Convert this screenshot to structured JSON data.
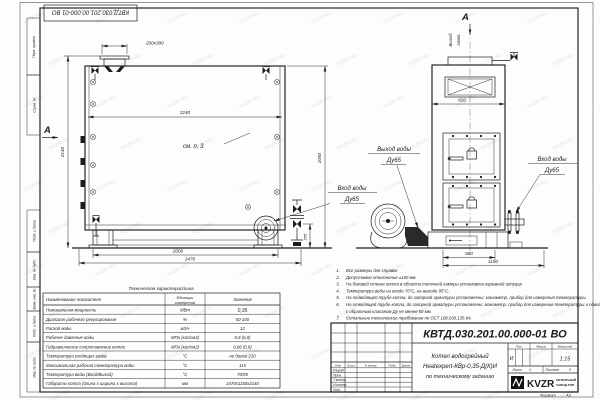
{
  "watermark": "KVZR.RU",
  "frame": {
    "doc_number_flipped": "КВТД.030.201.00.000-01 ВО",
    "format_label": "Формат",
    "format_value": "А3",
    "margin_labels": {
      "perv": "Перв. примен.",
      "sprav": "Справ. №",
      "podp1": "Подп. и дата",
      "inv_dubl": "Инв. № дубл.",
      "vzam": "Взам. инв. №",
      "podp2": "Подп. и дата",
      "inv_podl": "Инв. № подл."
    }
  },
  "front_view": {
    "section_letter": "А",
    "dim_chimney": "200х390",
    "dim_width_inner": "2240",
    "note_ref": "см. п. 3",
    "dim_height_total": "2140",
    "dim_height_body": "2050",
    "dim_inlet_height": "255",
    "dim_supports": "2000",
    "dim_length_total": "2470",
    "label_inlet_1": "Вход воды",
    "label_inlet_2": "Ду65"
  },
  "side_view": {
    "section_letter": "А",
    "label_gas_1": "Выход",
    "label_gas_2": "газов",
    "dim_width": "820",
    "dim_base": "580",
    "dim_depth": "1150",
    "label_outlet_1": "Выход воды",
    "label_outlet_2": "Ду65",
    "label_inlet_1": "Вход воды",
    "label_inlet_2": "Ду65"
  },
  "notes": {
    "items": [
      {
        "n": "1.",
        "t": "Все размеры для справок"
      },
      {
        "n": "2.",
        "t": "Допустимое отклонение ±100 мм."
      },
      {
        "n": "3.",
        "t": "На боковой стенке котла в области топочной камеры установлен взрывной штуцер"
      },
      {
        "n": "4.",
        "t": "Температура воды на входе 70°С, на выходе 95°С."
      },
      {
        "n": "5.",
        "t": "На подводящей трубе котла, до запорной арматуры установлены: манометр, прибор для измерения температуры."
      },
      {
        "n": "6.",
        "t": "На отводящей трубе котла, до запорной арматуры установлены: манометр, прибор для измерения температуры и обвод"
      },
      {
        "n": "",
        "t": "с обратным клапаном Ду не менее 50 мм."
      },
      {
        "n": "7.",
        "t": "Остальные технические требования по ОСТ 108.030.135-84."
      }
    ]
  },
  "spec_table": {
    "title": "Техническая характеристика",
    "col_name": "Наименование показателя",
    "col_units_1": "Единицы",
    "col_units_2": "измерения",
    "col_value": "Значение",
    "rows": [
      {
        "name": "Номинальная мощность",
        "units": "МВт",
        "value": "0,35"
      },
      {
        "name": "Диапазон рабочего регулирования",
        "units": "%",
        "value": "50-100"
      },
      {
        "name": "Расход воды",
        "units": "м3/ч",
        "value": "12"
      },
      {
        "name": "Рабочее давление воды",
        "units": "МПа (кгс/см2)",
        "value": "0,6 (6,0)"
      },
      {
        "name": "Гидравлическое сопротивление котла",
        "units": "МПа (кгс/см2)",
        "value": "0,06 (0,6)"
      },
      {
        "name": "Температура уходящих газов",
        "units": "°С",
        "value": "не более 220"
      },
      {
        "name": "Максимальная рабочая температура воды",
        "units": "°С",
        "value": "115"
      },
      {
        "name": "Температура воды (Вход/Выход)",
        "units": "°С",
        "value": "70/95"
      },
      {
        "name": "Габариты котла (длина х ширина х высота)",
        "units": "мм",
        "value": "2470х1150х2140"
      }
    ]
  },
  "title_block": {
    "doc_number": "КВТД.030.201.00.000-01 ВО",
    "name_line1": "Котел водогрейный",
    "name_line2": "Heatexpert-КВр-0,35-Д(К)И",
    "name_line3": "по техническому заданию",
    "col_izm": "Изм",
    "col_list": "Лист",
    "col_doc": "N докум.",
    "col_podp": "Подп.",
    "col_data": "Дата",
    "row_razrab": "Разраб.",
    "row_prov": "Пров.",
    "row_tkontr": "Т.контр.",
    "row_nkontr": "Н.контр.",
    "row_utv": "Утв.",
    "lit_label": "Лит",
    "massa_label": "Масса",
    "scale_label": "Масштаб",
    "lit_value": "И",
    "scale_value": "1:15",
    "sheet_label": "Лист",
    "sheet_value": "1",
    "sheets_label": "Листов",
    "sheets_value": "2",
    "logo_text": "KVZR",
    "company_line1": "КОТЕЛЬНЫЙ",
    "company_line2": "ЗАВОД РЭП"
  }
}
